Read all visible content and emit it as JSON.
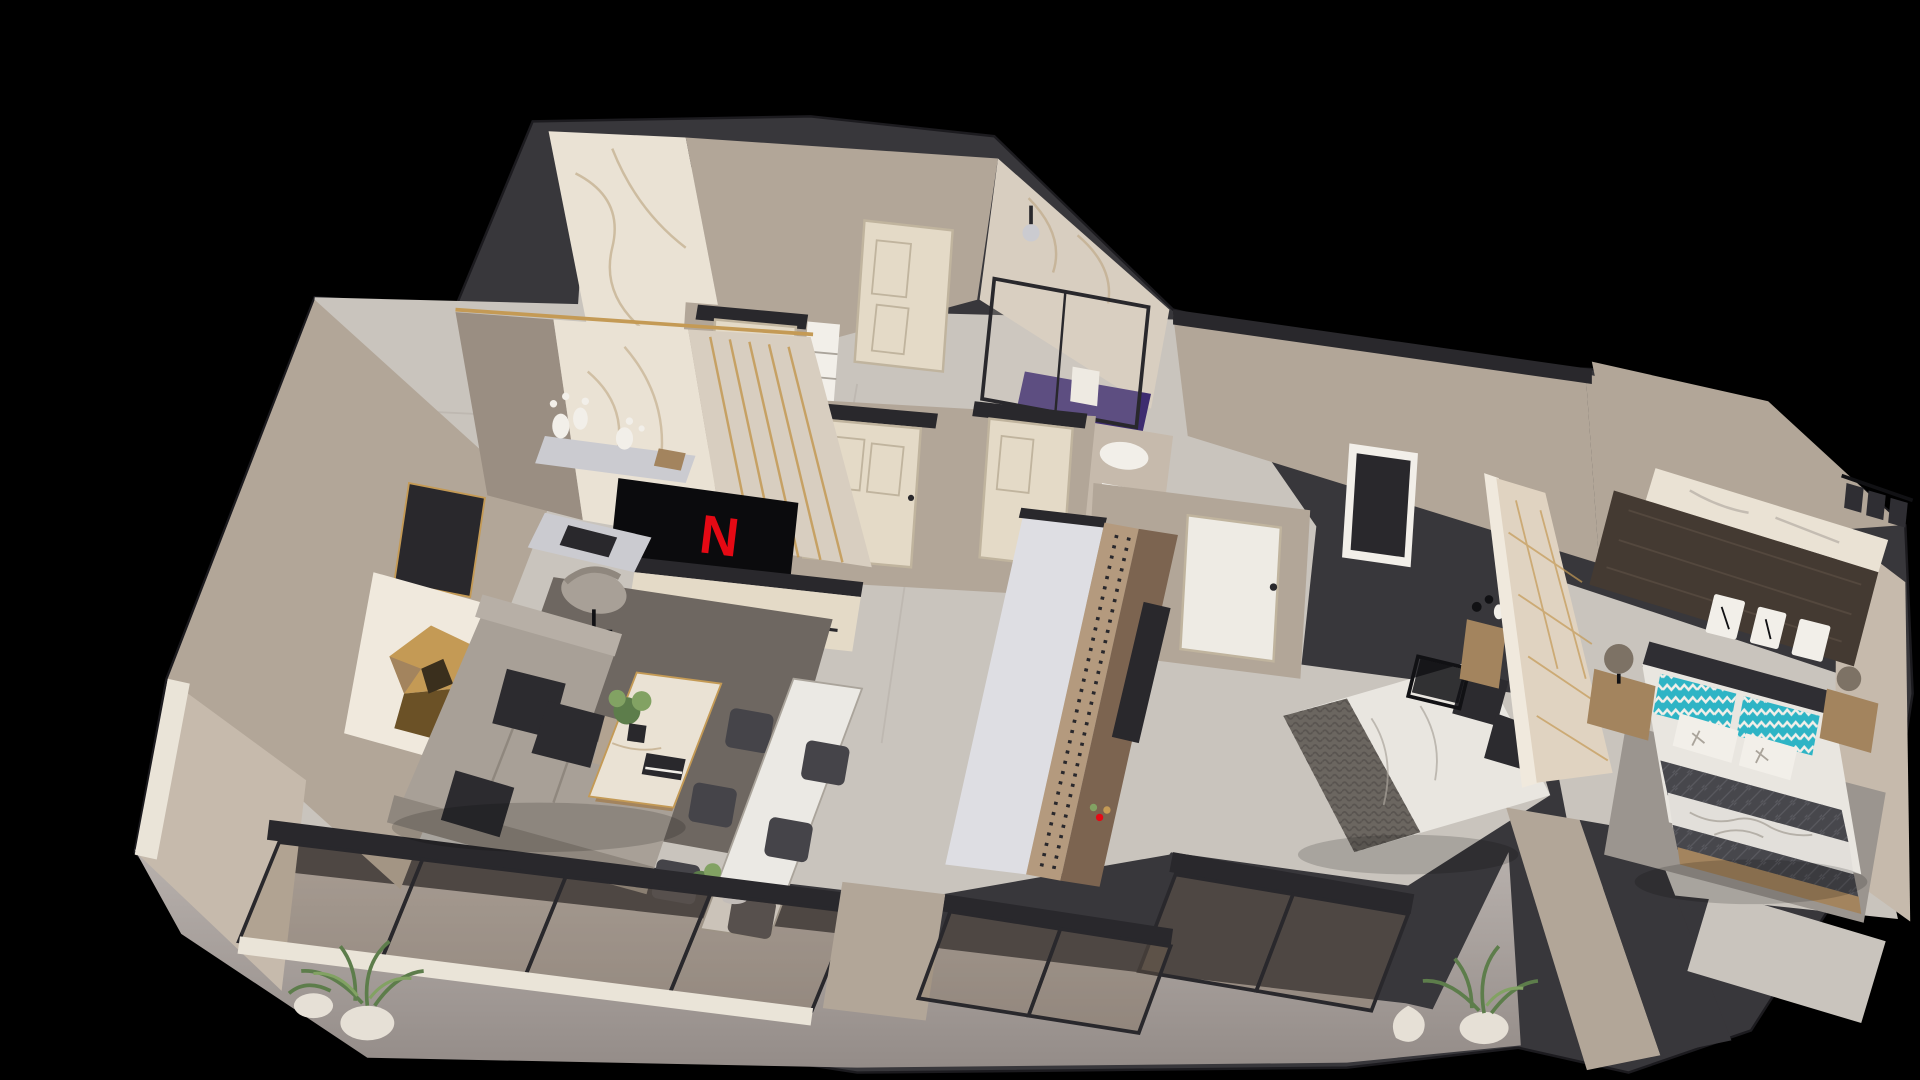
{
  "meta": {
    "title": "3D isometric apartment floor plan render",
    "canvas": {
      "width": 1920,
      "height": 1080
    }
  },
  "palette": {
    "bg": "#000000",
    "shell": "#38373b",
    "capDark": "#29282c",
    "beige": "#b2a698",
    "beigeLight": "#c6baac",
    "beigeDark": "#9a8e82",
    "marble": "#d8cec0",
    "marbleBright": "#eae2d4",
    "vein": "#b59c74",
    "woodFloor": "#c9c4bd",
    "plank": "#aaa49b",
    "sill": "#eae4d8",
    "rugDark": "#6e6761",
    "rugGray": "#9b958f",
    "purple": "#3d2c70",
    "sofa": "#a8a097",
    "sofaShade": "#8f877e",
    "sofaLight": "#b7afa6",
    "cushionDark": "#2c2b2f",
    "cushionTan": "#b2a391",
    "white": "#f2efe9",
    "tableWhite": "#ebe9e4",
    "gold": "#c49a55",
    "bronzeDark": "#6b5126",
    "goldCore": "#3a2f1d",
    "tvBlack": "#0b0b0d",
    "red": "#e50914",
    "door": "#e4dac7",
    "doorFrame": "#c0b49e",
    "doorWhite": "#eeebe4",
    "cabinet": "#cbcbd0",
    "cabinetLight": "#dedee3",
    "studTan": "#b49a7e",
    "wood": "#7c6450",
    "woodLight": "#a3845e",
    "woodDark": "#53443a",
    "wardrobe": "#443a32",
    "wardrobeStreak": "#5b4e44",
    "panel": "#e0d3c1",
    "panelTrim": "#f0e9dd",
    "headboardDark": "#2f2e33",
    "teal": "#2eb4c5",
    "duvet": "#e9e6e0",
    "knit": "#6b6660",
    "knitDark": "#595450",
    "quilt": "#47474c",
    "quiltLine": "#5a5a60",
    "sheetPrint": "#e2dfda",
    "glass": "rgba(130,108,86,0.30)",
    "glassLight": "rgba(225,215,200,0.20)",
    "frame": "#29282c",
    "green": "#5d7d4b",
    "greenLight": "#82a263",
    "pot": "#e6e0d6",
    "lamp": "#7d7265",
    "chairDark": "#454449",
    "black": "#111114"
  },
  "scene": {
    "view": "isometric-cutaway-3d-floor-plan",
    "tv": {
      "logo": "N"
    },
    "rooms": [
      {
        "id": "entry-hall",
        "features": [
          "marble-feature-wall",
          "shoe-cabinet",
          "interior-door",
          "linen-shelves"
        ]
      },
      {
        "id": "bathroom",
        "features": [
          "glass-shower",
          "purple-tile-floor",
          "rain-shower-head",
          "towel-rail",
          "toilet",
          "vanity-sink"
        ]
      },
      {
        "id": "hallway",
        "features": [
          "cream-doors",
          "tall-gray-cabinet",
          "studded-partition"
        ]
      },
      {
        "id": "living-room",
        "features": [
          "l-shaped-sofa",
          "dark-cushions",
          "geometric-gold-wall-art",
          "marble-coffee-table",
          "area-rug",
          "desk",
          "office-chair",
          "tv-console",
          "wall-mounted-tv"
        ]
      },
      {
        "id": "dining-area",
        "features": [
          "white-dining-table",
          "six-dark-chairs",
          "table-plant"
        ]
      },
      {
        "id": "bedroom-middle",
        "features": [
          "double-bed-knit-throw",
          "upholstered-headboard-wall",
          "black-metal-nightstand",
          "wood-side-table",
          "wood-dresser",
          "balcony-glazing",
          "window"
        ]
      },
      {
        "id": "bedroom-right",
        "features": [
          "double-bed-teal-chevron-pillows",
          "quilted-blanket",
          "floral-throw",
          "dark-wood-wardrobe",
          "marble-ledge",
          "clothes-rail",
          "nightstands",
          "table-lamps",
          "gray-rug"
        ]
      },
      {
        "id": "balcony",
        "features": [
          "concrete-floor",
          "glass-sliding-wall",
          "potted-plants"
        ]
      },
      {
        "id": "terrace",
        "features": [
          "concrete-floor",
          "potted-plant",
          "white-planter"
        ]
      }
    ]
  }
}
